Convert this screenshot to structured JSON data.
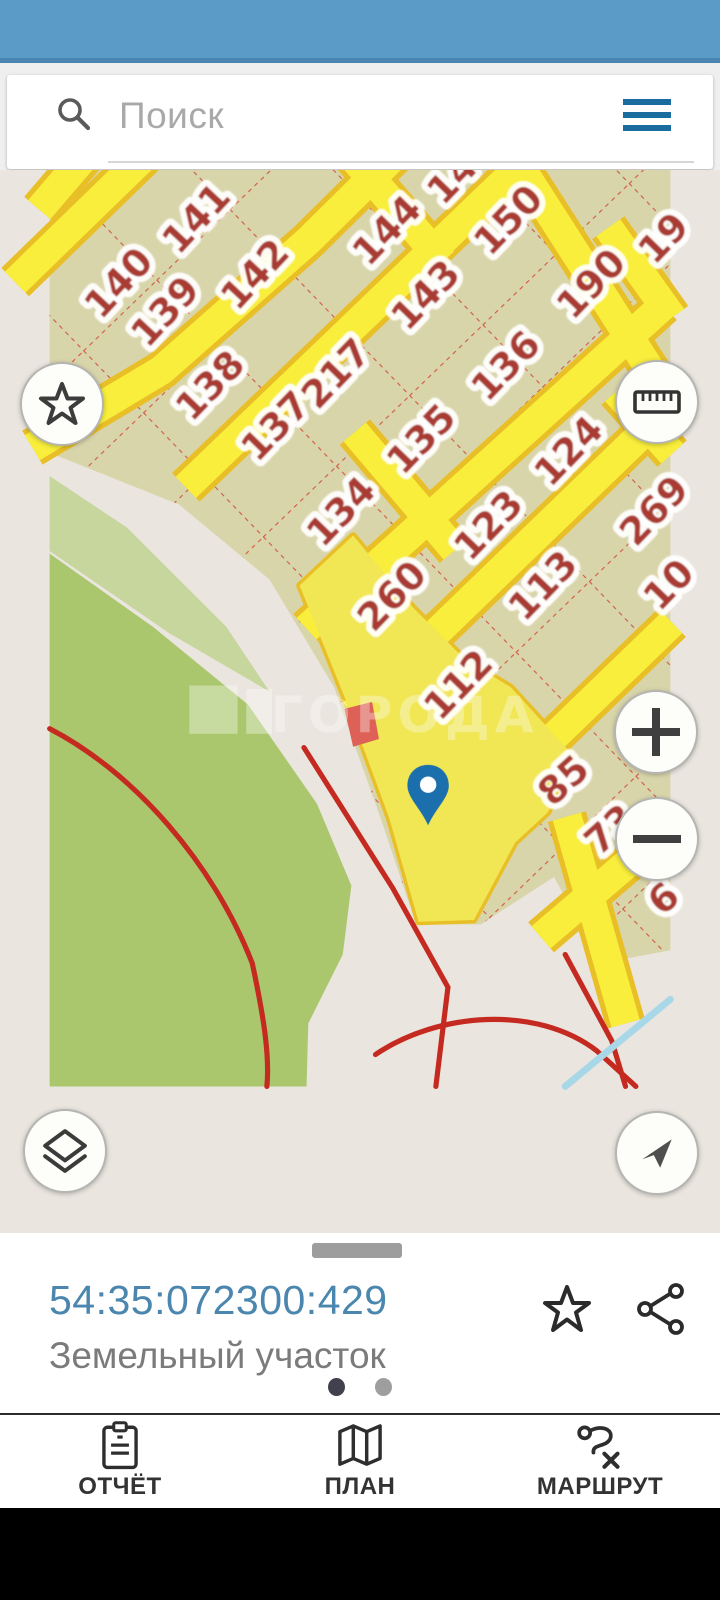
{
  "colors": {
    "status_bar": "#5b9bc8",
    "status_bar_dark": "#4a85b2",
    "accent": "#1a6b9e",
    "cadastral_link": "#4b86af",
    "map_beige": "#eae5de",
    "map_parcel": "#d9d5ab",
    "map_road": "#f8ee3b",
    "map_road_border": "#e9bf27",
    "map_dash": "#cf3a2c",
    "map_number": "#a93a31",
    "map_green": "#abc76d",
    "map_green_light": "#c6d69c",
    "map_red_line": "#c52a20",
    "map_cyan_line": "#a8d8e8",
    "pin": "#1c6fad"
  },
  "search": {
    "placeholder": "Поиск",
    "search_icon": "magnifier-icon",
    "menu_icon": "hamburger-icon"
  },
  "map": {
    "watermark": "ГОРОДА",
    "pin": "map-pin",
    "controls": {
      "favorite": "star-icon",
      "measure": "ruler-icon",
      "zoom_in": "plus-icon",
      "zoom_out": "minus-icon",
      "layers": "layers-icon",
      "my_location": "navigation-arrow-icon"
    },
    "parcel_labels": [
      {
        "label": "140",
        "x": 80,
        "y": 301,
        "r": -47
      },
      {
        "label": "141",
        "x": 170,
        "y": 226,
        "r": -47
      },
      {
        "label": "139",
        "x": 134,
        "y": 334,
        "r": -47
      },
      {
        "label": "142",
        "x": 238,
        "y": 291,
        "r": -47
      },
      {
        "label": "14",
        "x": 467,
        "y": 180,
        "r": -46
      },
      {
        "label": "138",
        "x": 186,
        "y": 420,
        "r": -46
      },
      {
        "label": "137",
        "x": 262,
        "y": 467,
        "r": -46
      },
      {
        "label": "217",
        "x": 332,
        "y": 406,
        "r": -46
      },
      {
        "label": "144",
        "x": 391,
        "y": 240,
        "r": -46
      },
      {
        "label": "143",
        "x": 436,
        "y": 315,
        "r": -46
      },
      {
        "label": "150",
        "x": 532,
        "y": 228,
        "r": -46
      },
      {
        "label": "19",
        "x": 712,
        "y": 249,
        "r": -46
      },
      {
        "label": "190",
        "x": 628,
        "y": 302,
        "r": -46
      },
      {
        "label": "136",
        "x": 529,
        "y": 397,
        "r": -46
      },
      {
        "label": "135",
        "x": 431,
        "y": 482,
        "r": -46
      },
      {
        "label": "134",
        "x": 338,
        "y": 566,
        "r": -46
      },
      {
        "label": "12",
        "x": 704,
        "y": 429,
        "r": -46
      },
      {
        "label": "124",
        "x": 602,
        "y": 496,
        "r": -46
      },
      {
        "label": "123",
        "x": 509,
        "y": 582,
        "r": -46
      },
      {
        "label": "269",
        "x": 701,
        "y": 565,
        "r": -46
      },
      {
        "label": "260",
        "x": 397,
        "y": 664,
        "r": -46
      },
      {
        "label": "113",
        "x": 572,
        "y": 652,
        "r": -46
      },
      {
        "label": "10",
        "x": 718,
        "y": 651,
        "r": -46
      },
      {
        "label": "112",
        "x": 474,
        "y": 767,
        "r": -46
      },
      {
        "label": "85",
        "x": 596,
        "y": 878,
        "r": -42
      },
      {
        "label": "73",
        "x": 650,
        "y": 935,
        "r": -42
      },
      {
        "label": "6",
        "x": 712,
        "y": 1015,
        "r": -42
      }
    ]
  },
  "bottom_sheet": {
    "cadastral_number": "54:35:072300:429",
    "subtitle": "Земельный участок",
    "favorite_icon": "star-outline-icon",
    "share_icon": "share-icon",
    "dots": {
      "count": 2,
      "active_index": 0
    }
  },
  "bottom_nav": {
    "items": [
      {
        "label": "ОТЧЁТ",
        "icon": "clipboard-icon"
      },
      {
        "label": "ПЛАН",
        "icon": "folded-map-icon"
      },
      {
        "label": "МАРШРУТ",
        "icon": "route-icon"
      }
    ]
  }
}
